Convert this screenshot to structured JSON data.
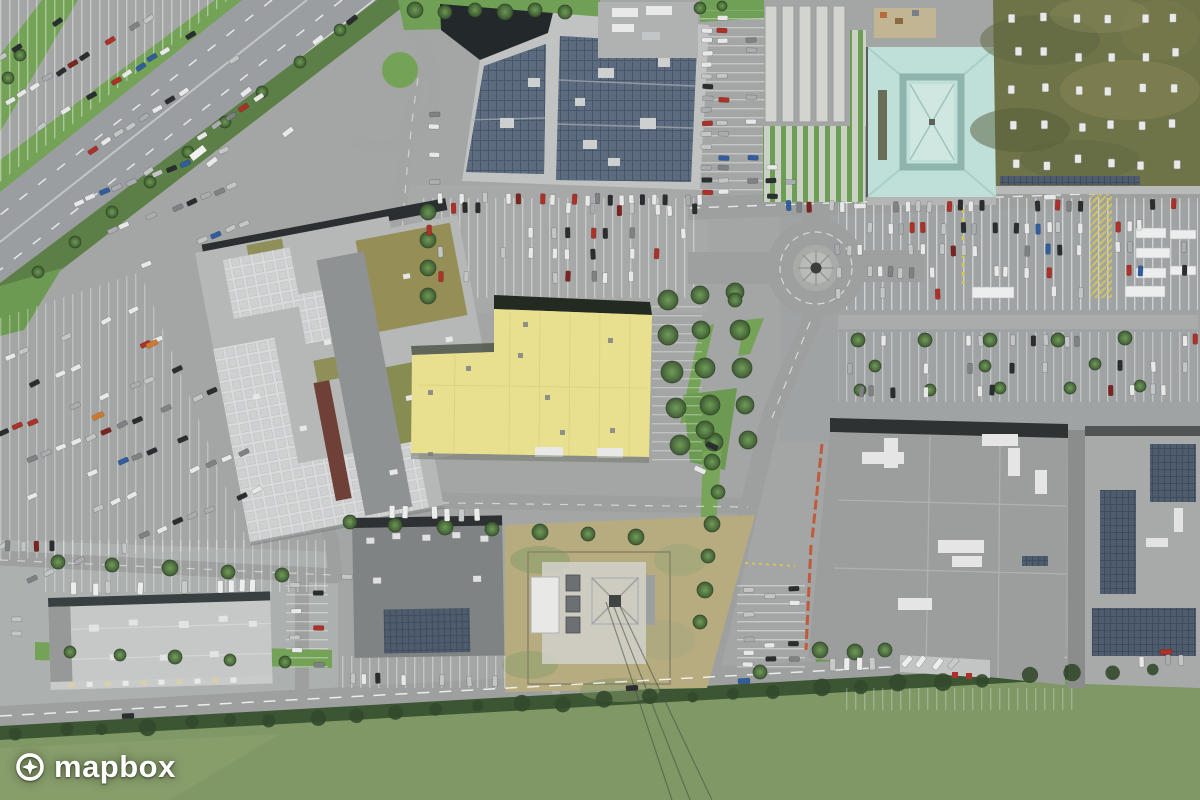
{
  "watermark": {
    "logo_text": "mapbox",
    "position": "bottom-left"
  },
  "icons": {
    "mapbox_logo_icon": "compass-star-in-circle"
  },
  "map_view": {
    "imagery": "satellite-aerial",
    "scene": "retail park with motorway, roundabout, car parks and big-box stores"
  },
  "colors": {
    "asphalt": "#a4a6a5",
    "road": "#9da09f",
    "highway": "#9b9ea0",
    "grass": "#74a257",
    "hedge": "#3c5634",
    "field": "#7f9865",
    "dry_field": "#b7ab80",
    "yellow_store_roof": "#e9e08f",
    "teal_roof": "#bfdfd9",
    "green_roof": "#6f7448",
    "solar_panel": "#5c6b7d",
    "mall_roof": "#b6b8b7",
    "warehouse_roof": "#c6c8c7",
    "dark_store_roof": "#808384",
    "big_store_roof": "#9c9e9d",
    "logo": "#ffffff"
  }
}
